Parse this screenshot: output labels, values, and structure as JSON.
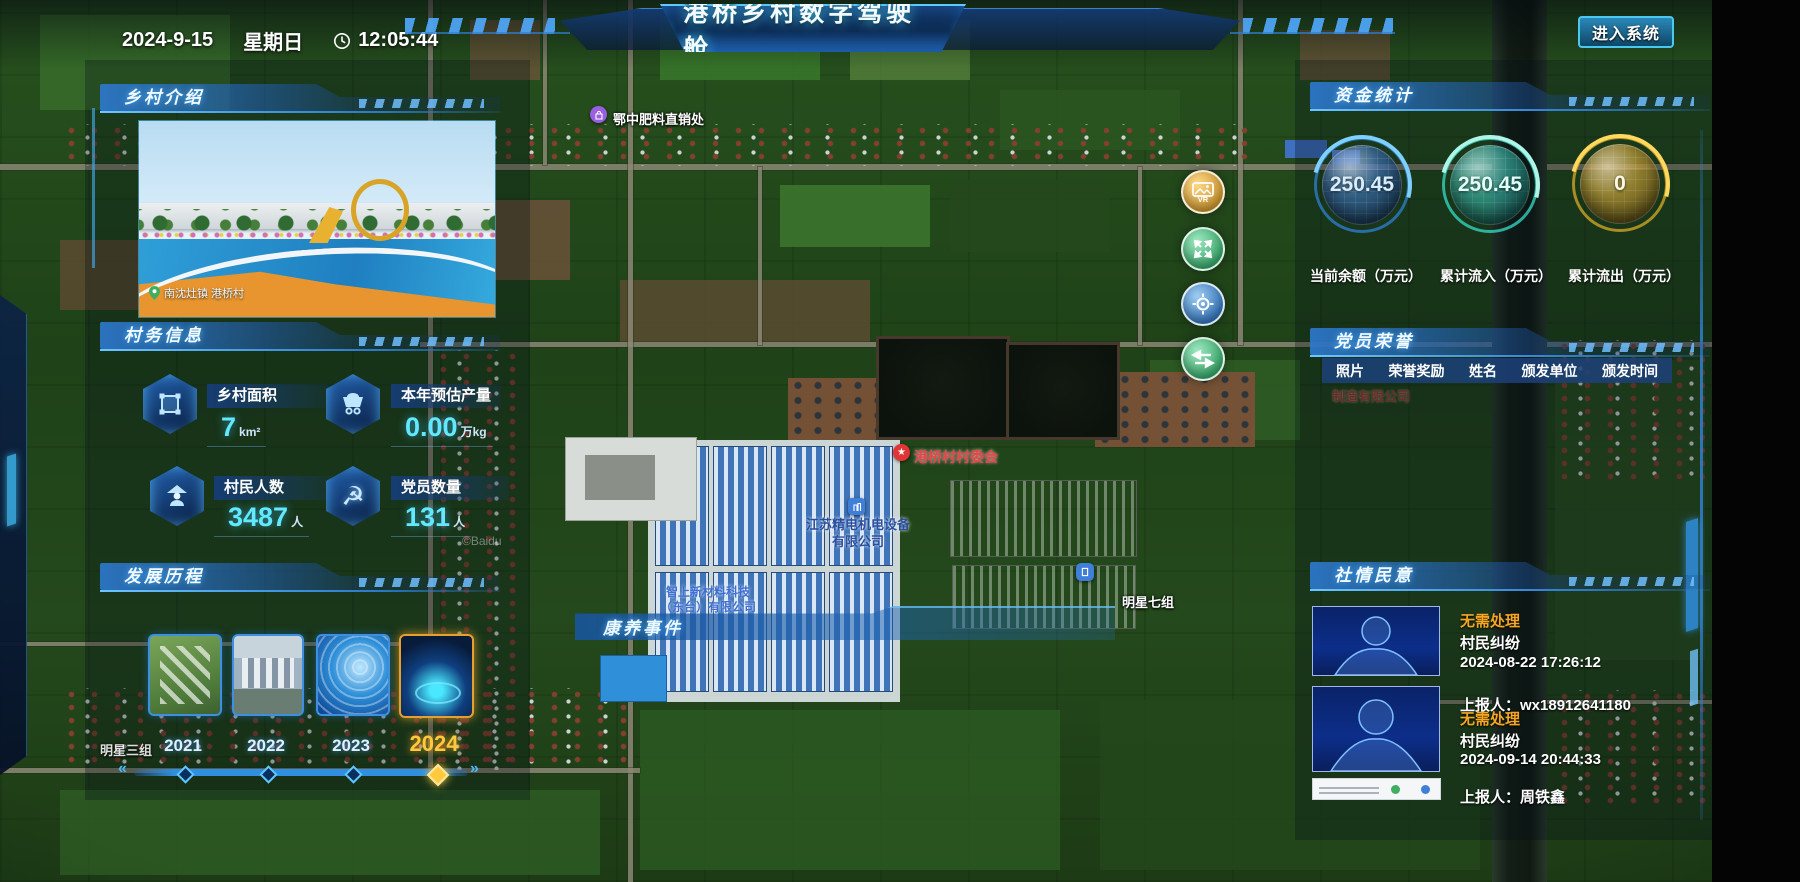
{
  "topbar": {
    "date": "2024-9-15",
    "weekday": "星期日",
    "time": "12:05:44",
    "title": "港桥乡村数字驾驶舱",
    "chev_l": "«",
    "chev_r": "»",
    "enter": "进入系统"
  },
  "panels": {
    "intro": {
      "title": "乡村介绍",
      "caption": "南沈灶镇 港桥村"
    },
    "affairs": {
      "title": "村务信息",
      "stats": [
        {
          "label": "乡村面积",
          "value": "7",
          "unit": "km²"
        },
        {
          "label": "本年预估产量",
          "value": "0.00",
          "unit": "万kg"
        },
        {
          "label": "村民人数",
          "value": "3487",
          "unit": "人"
        },
        {
          "label": "党员数量",
          "value": "131",
          "unit": "人"
        }
      ]
    },
    "history": {
      "title": "发展历程",
      "years": [
        {
          "label": "2021"
        },
        {
          "label": "2022"
        },
        {
          "label": "2023"
        },
        {
          "label": "2024"
        }
      ]
    },
    "funds": {
      "title": "资金统计",
      "gauges": [
        {
          "value": "250.45",
          "label": "当前余额（万元）",
          "color": "#3f8fe0"
        },
        {
          "value": "250.45",
          "label": "累计流入（万元）",
          "color": "#35dcc8"
        },
        {
          "value": "0",
          "label": "累计流出（万元）",
          "color": "#d8a928"
        }
      ]
    },
    "honors": {
      "title": "党员荣誉",
      "columns": [
        "照片",
        "荣誉奖励",
        "姓名",
        "颁发单位",
        "颁发时间"
      ]
    },
    "opinions": {
      "title": "社情民意",
      "items": [
        {
          "status": "无需处理",
          "type": "村民纠纷",
          "time": "2024-08-22 17:26:12",
          "reporter": "上报人：wx18912641180"
        },
        {
          "status": "无需处理",
          "type": "村民纠纷",
          "time": "2024-09-14 20:44:33",
          "reporter": "上报人：周铁鑫"
        }
      ]
    },
    "health": {
      "title": "康养事件"
    }
  },
  "map": {
    "fertilizer": "鄂中肥料直销处",
    "committee": "港桥村村委会",
    "company1a": "江苏精电机电设备",
    "company1b": "有限公司",
    "company2a": "智上新材料科技",
    "company2b": "（东台）有限公司",
    "group7": "明星七组",
    "group3": "明星三组",
    "faint_company": "制造有限公司",
    "watermark": "©Baidu",
    "vr_label": "VR"
  },
  "colors": {
    "accent": "#35c8ff",
    "gold": "#f0b32c",
    "status_orange": "#f5a623",
    "value_cyan": "#63e9ff"
  }
}
